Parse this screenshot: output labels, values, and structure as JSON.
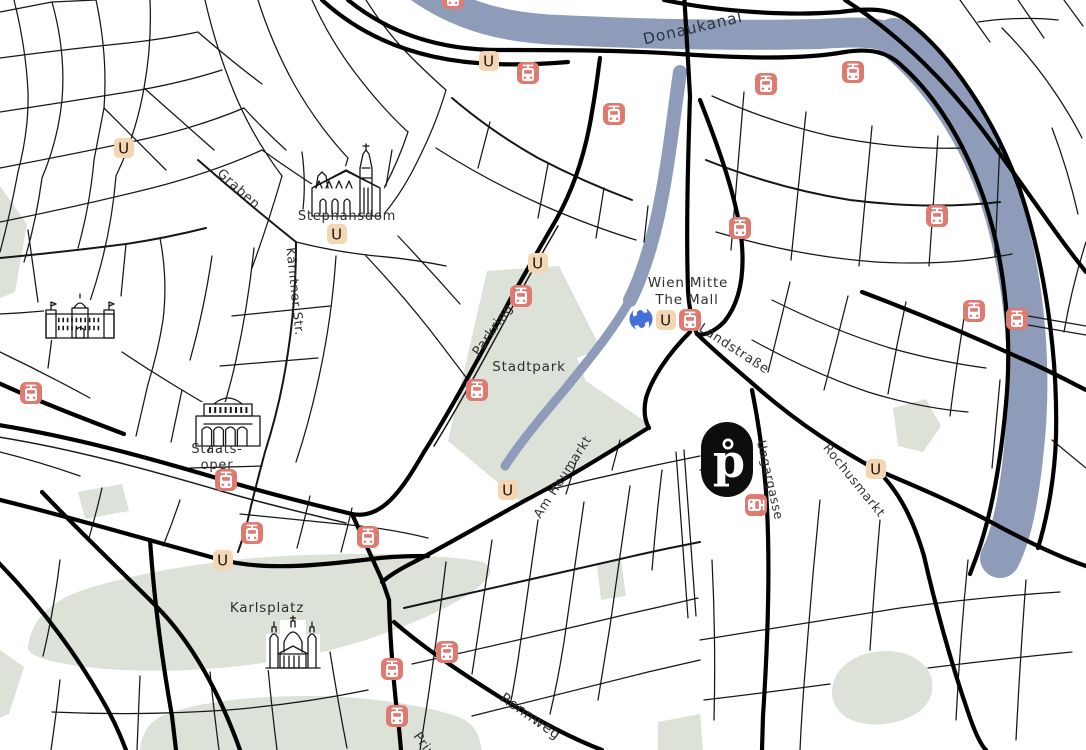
{
  "map": {
    "title": "Vienna city map",
    "colors": {
      "background": "#ffffff",
      "river": "#8e9cba",
      "park": "#dce2d8",
      "street": "#161616",
      "label": "#2e2e2e",
      "river_label": "#2b3447",
      "ubahn_bg": "#f4d7b2",
      "ubahn_letter_color": "#141414",
      "tram_bg": "#df7a71",
      "tram_glyph_color": "#ffffff",
      "sbahn_bg": "#4271da",
      "sbahn_letter_color": "#ffffff",
      "hotel_pin_bg": "#0d0d0d",
      "hotel_pin_letter_color": "#ffffff"
    },
    "transit": {
      "ubahn_letter": "U",
      "sbahn_letter": "S",
      "ubahn_stations": [
        {
          "x": 124,
          "y": 148
        },
        {
          "x": 337,
          "y": 234
        },
        {
          "x": 489,
          "y": 61
        },
        {
          "x": 538,
          "y": 263
        },
        {
          "x": 666,
          "y": 320
        },
        {
          "x": 508,
          "y": 490
        },
        {
          "x": 876,
          "y": 469
        },
        {
          "x": 223,
          "y": 560
        }
      ],
      "tram_stops": [
        {
          "x": 453,
          "y": -2
        },
        {
          "x": 528,
          "y": 73
        },
        {
          "x": 614,
          "y": 114
        },
        {
          "x": 766,
          "y": 84
        },
        {
          "x": 853,
          "y": 72
        },
        {
          "x": 937,
          "y": 216
        },
        {
          "x": 974,
          "y": 311
        },
        {
          "x": 1017,
          "y": 319
        },
        {
          "x": 690,
          "y": 320
        },
        {
          "x": 740,
          "y": 228
        },
        {
          "x": 521,
          "y": 296
        },
        {
          "x": 477,
          "y": 390
        },
        {
          "x": 756,
          "y": 505,
          "rot": 90
        },
        {
          "x": 226,
          "y": 480
        },
        {
          "x": 252,
          "y": 533
        },
        {
          "x": 31,
          "y": 393
        },
        {
          "x": 368,
          "y": 537
        },
        {
          "x": 447,
          "y": 652
        },
        {
          "x": 392,
          "y": 669
        },
        {
          "x": 397,
          "y": 716
        }
      ],
      "sbahn_station": {
        "x": 641,
        "y": 319
      }
    },
    "hotel_pin": {
      "letter": "p",
      "x": 727,
      "y": 459
    },
    "labels": [
      {
        "text": "Donaukanal",
        "x": 694,
        "y": 33,
        "rot": -13,
        "size": 15.5,
        "kind": "river-label",
        "color": "#2b3447",
        "ls": "0.14em"
      },
      {
        "text": "Graben",
        "x": 236,
        "y": 192,
        "rot": 42,
        "size": 13,
        "kind": "street-label"
      },
      {
        "text": "Kärntner Str.",
        "x": 291,
        "y": 292,
        "rot": 84,
        "size": 12.5,
        "kind": "street-label"
      },
      {
        "text": "Stephansdom",
        "x": 347,
        "y": 220,
        "rot": 0,
        "size": 13,
        "kind": "place-label"
      },
      {
        "text": "Parkring",
        "x": 496,
        "y": 332,
        "rot": -55,
        "size": 13,
        "kind": "street-label"
      },
      {
        "text": "Stadtpark",
        "x": 529,
        "y": 371,
        "rot": 0,
        "size": 13.5,
        "kind": "place-label"
      },
      {
        "text": "Wien Mitte",
        "x": 688,
        "y": 287,
        "rot": 0,
        "size": 13.5,
        "kind": "place-label"
      },
      {
        "text": "The Mall",
        "x": 687,
        "y": 304,
        "rot": 0,
        "size": 13.5,
        "kind": "place-label"
      },
      {
        "text": "Landstraße",
        "x": 732,
        "y": 352,
        "rot": 33,
        "size": 13,
        "kind": "street-label"
      },
      {
        "text": "Am Heumarkt",
        "x": 566,
        "y": 479,
        "rot": -57,
        "size": 12.5,
        "kind": "street-label"
      },
      {
        "text": "Ungargasse",
        "x": 766,
        "y": 481,
        "rot": 77,
        "size": 12.5,
        "kind": "street-label"
      },
      {
        "text": "Rochusmarkt",
        "x": 851,
        "y": 483,
        "rot": 51,
        "size": 12.5,
        "kind": "street-label"
      },
      {
        "text": "Karlsplatz",
        "x": 267,
        "y": 612,
        "rot": 0,
        "size": 13.5,
        "kind": "place-label"
      },
      {
        "text": "Staats-",
        "x": 217,
        "y": 453,
        "rot": 0,
        "size": 13,
        "kind": "place-label"
      },
      {
        "text": "oper",
        "x": 217,
        "y": 469,
        "rot": 0,
        "size": 13,
        "kind": "place-label"
      },
      {
        "text": "Rennweg",
        "x": 528,
        "y": 720,
        "rot": 35,
        "size": 14,
        "kind": "street-label"
      },
      {
        "text": "Prinz",
        "x": 413,
        "y": 736,
        "rot": 55,
        "size": 13,
        "kind": "street-label",
        "anchor": "start"
      }
    ],
    "landmarks": [
      {
        "name": "stephansdom-building"
      },
      {
        "name": "staatsoper-building"
      },
      {
        "name": "karlskirche-building"
      },
      {
        "name": "palace-building"
      }
    ]
  }
}
